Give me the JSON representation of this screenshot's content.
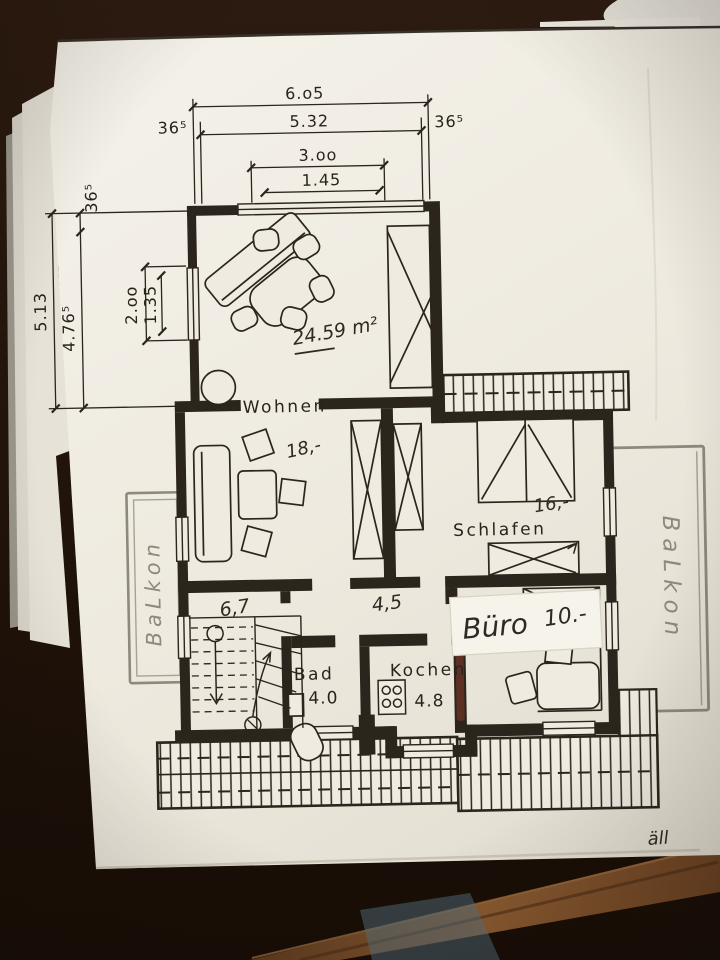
{
  "colors": {
    "ink": "#2b251d",
    "pencil": "#8f897b",
    "paper": "#efebe1",
    "wood_dark": "#241710",
    "wood_light": "#7d5129",
    "red_mark": "#6e3526"
  },
  "dims": {
    "top_total": "6.o5",
    "top_inner": "5.32",
    "top_side_left": "36⁵",
    "top_side_right": "36⁵",
    "top_window": "3.oo",
    "top_window_inner": "1.45",
    "left_total": "5.13",
    "left_inner": "4.76⁵",
    "left_side": "36⁵",
    "left_window": "2.oo",
    "left_window_inner": "1.35"
  },
  "rooms": {
    "wohnen": {
      "label": "Wohnen",
      "area": "24.59 m²",
      "rent": "18,-"
    },
    "schlafen": {
      "label": "Schlafen",
      "rent": "16,-"
    },
    "bad": {
      "label": "Bad",
      "size": "4.0"
    },
    "kochen": {
      "label": "Kochen",
      "size": "4.8"
    },
    "buero": {
      "label": "Büro",
      "rent": "10.-"
    },
    "flur": {
      "left": "6,7",
      "right": "4,5"
    },
    "balkon_left": {
      "label": "BaLkon"
    },
    "balkon_right": {
      "label": "BaLkon"
    }
  },
  "notes": {
    "signature": "äll"
  }
}
